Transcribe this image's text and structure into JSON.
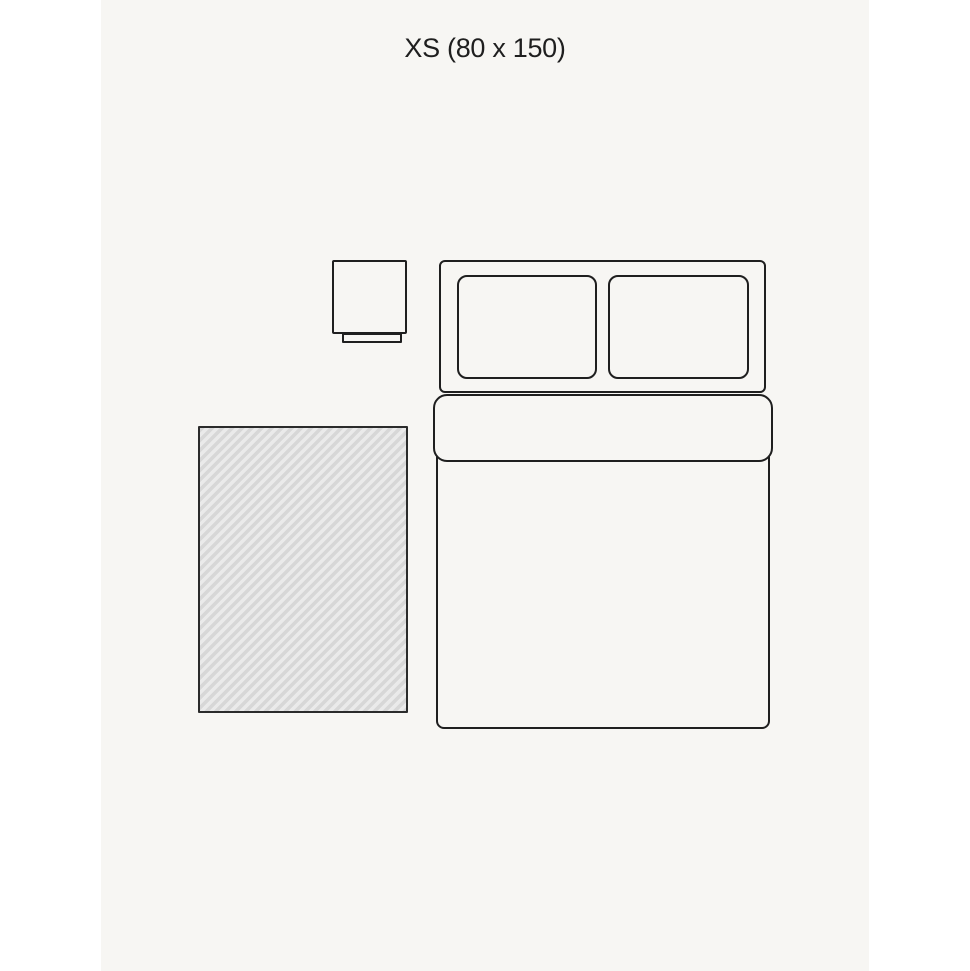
{
  "title": "XS (80 x 150)",
  "size": {
    "code": "XS",
    "dimensions_label": "80 x 150"
  },
  "colors": {
    "page_background": "#ffffff",
    "canvas_background": "#f7f6f3",
    "outline": "#1f1f1f",
    "rug_outline": "#2b2b2b",
    "rug_stripe_dark": "#d7d7d7",
    "rug_stripe_light": "#eaeaea"
  },
  "diagram": {
    "items": [
      "nightstand",
      "double-bed",
      "rug"
    ]
  }
}
